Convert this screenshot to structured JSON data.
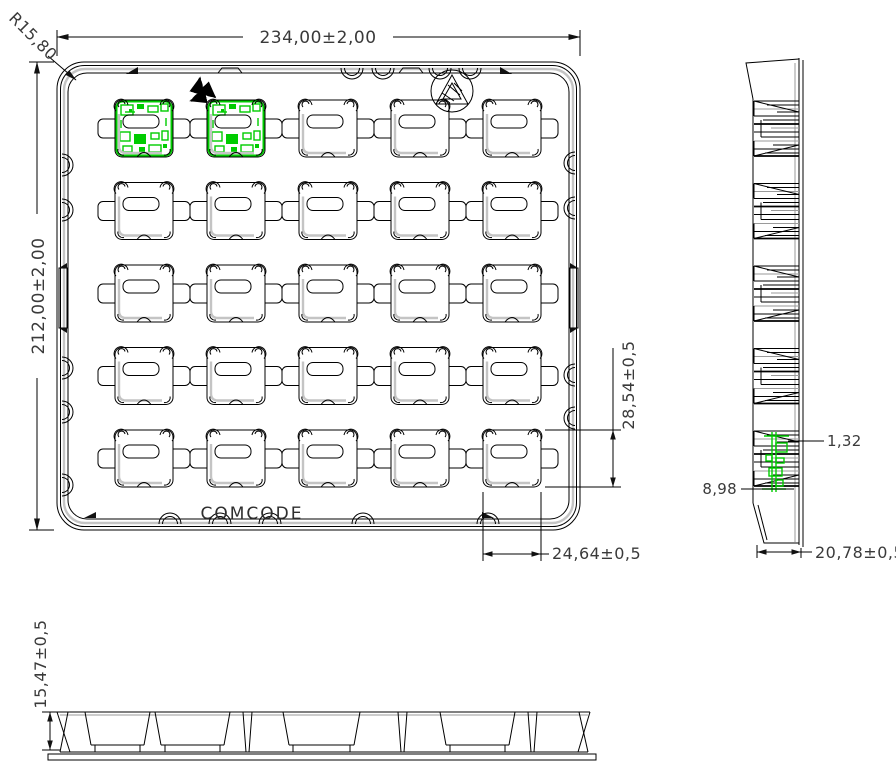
{
  "drawing": {
    "top_view": {
      "tray_label": "COMCODE",
      "grid_rows": 5,
      "grid_cols": 5,
      "pcb_pockets": [
        [
          0,
          0
        ],
        [
          0,
          1
        ]
      ],
      "dim_overall_width": "234,00±2,00",
      "dim_overall_height": "212,00±2,00",
      "dim_corner_radius": "R15,80",
      "dim_pocket_height": "28,54±0,5",
      "dim_pocket_width": "24,64±0,5",
      "icons": [
        "recycling-icon",
        "material-mark-icon"
      ]
    },
    "side_view": {
      "dim_pcb_thickness": "1,32",
      "dim_pocket_depth": "8,98",
      "dim_profile_width": "20,78±0,5"
    },
    "front_view": {
      "dim_tray_height": "15,47±0,5"
    },
    "colors": {
      "line": "#000000",
      "pcb_green": "#00cc00",
      "shade_gray": "#c4c4c4"
    }
  }
}
